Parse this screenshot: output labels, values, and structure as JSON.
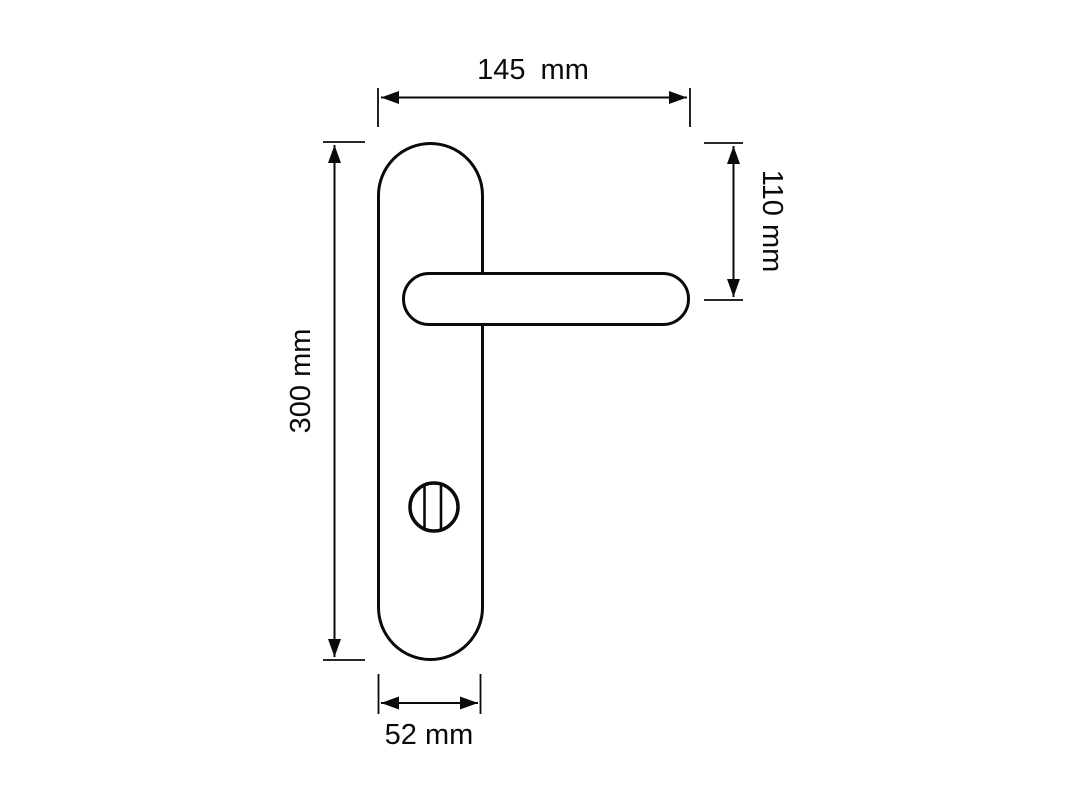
{
  "page": {
    "background_color": "#ffffff",
    "line_color": "#0a0a0a"
  },
  "drawing": {
    "type": "technical-dimension-drawing",
    "subject": "lever door handle on long backplate with thumbturn",
    "dimensions": [
      {
        "name": "overall-width",
        "value": 145,
        "unit": "mm",
        "label": "145 mm",
        "orientation": "horizontal-top"
      },
      {
        "name": "handle-vertical-offset",
        "value": 110,
        "unit": "mm",
        "label": "110 mm",
        "orientation": "vertical-right"
      },
      {
        "name": "plate-height",
        "value": 300,
        "unit": "mm",
        "label": "300 mm",
        "orientation": "vertical-left"
      },
      {
        "name": "plate-width",
        "value": 52,
        "unit": "mm",
        "label": "52 mm",
        "orientation": "horizontal-bottom"
      }
    ]
  }
}
